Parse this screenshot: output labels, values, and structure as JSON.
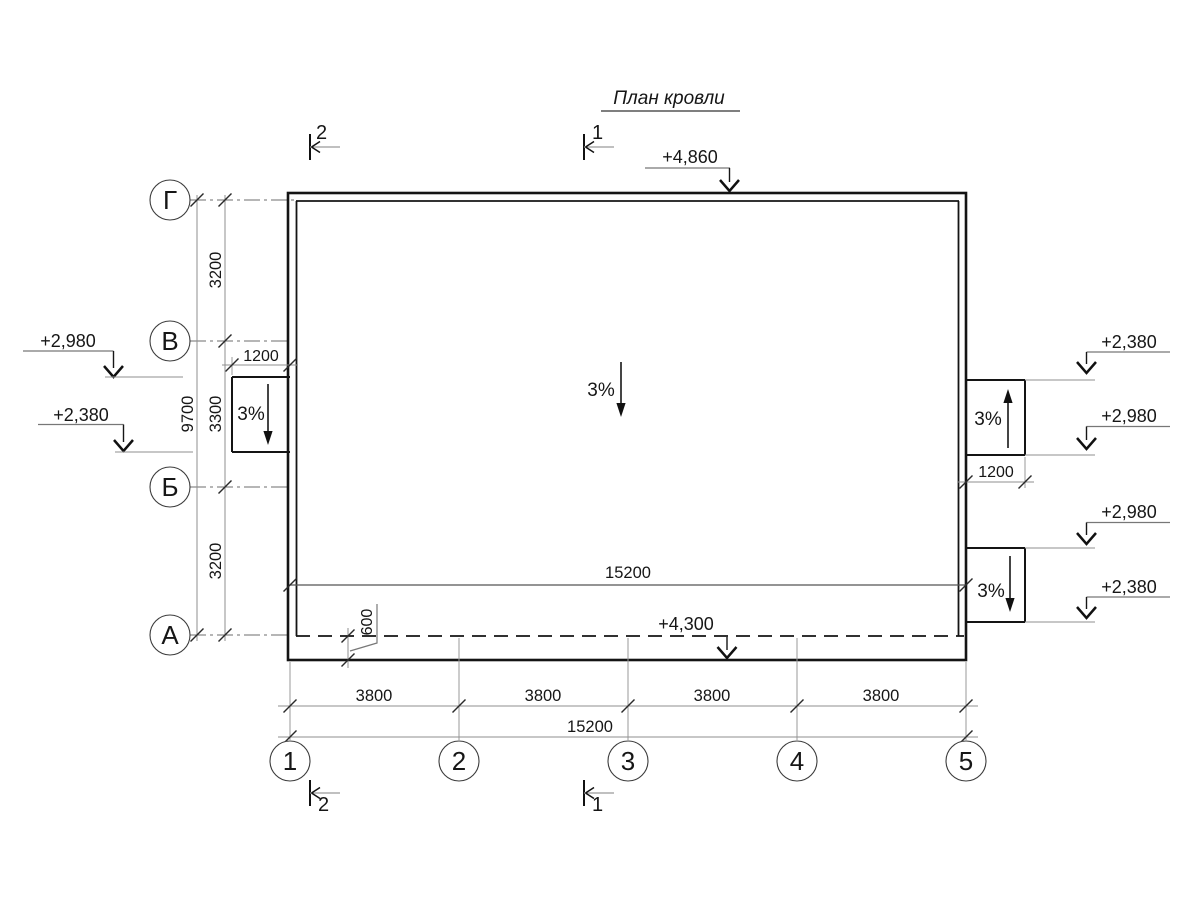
{
  "title": "План кровли",
  "axis_letters": [
    "Г",
    "В",
    "Б",
    "А"
  ],
  "axis_numbers": [
    "1",
    "2",
    "3",
    "4",
    "5"
  ],
  "sections": {
    "top_left": "2",
    "top_center": "1",
    "bottom_left": "2",
    "bottom_center": "1"
  },
  "elevations": {
    "ridge": "+4,860",
    "eave": "+4,300",
    "left_top": "+2,980",
    "left_bottom": "+2,380",
    "right_1": "+2,380",
    "right_2": "+2,980",
    "right_3": "+2,980",
    "right_4": "+2,380"
  },
  "slopes": {
    "center": "3%",
    "left_canopy": "3%",
    "right_canopy_upper": "3%",
    "right_canopy_lower": "3%"
  },
  "dims": {
    "left_segments": [
      "3200",
      "3300",
      "3200"
    ],
    "left_total": "9700",
    "bottom_segments": [
      "3800",
      "3800",
      "3800",
      "3800"
    ],
    "bottom_total": "15200",
    "roof_inner_width": "15200",
    "canopy_left_width": "1200",
    "canopy_right_width": "1200",
    "overhang": "600"
  },
  "colors": {
    "line": "#141414",
    "dim_line": "#8f8f8f",
    "background": "#ffffff"
  }
}
